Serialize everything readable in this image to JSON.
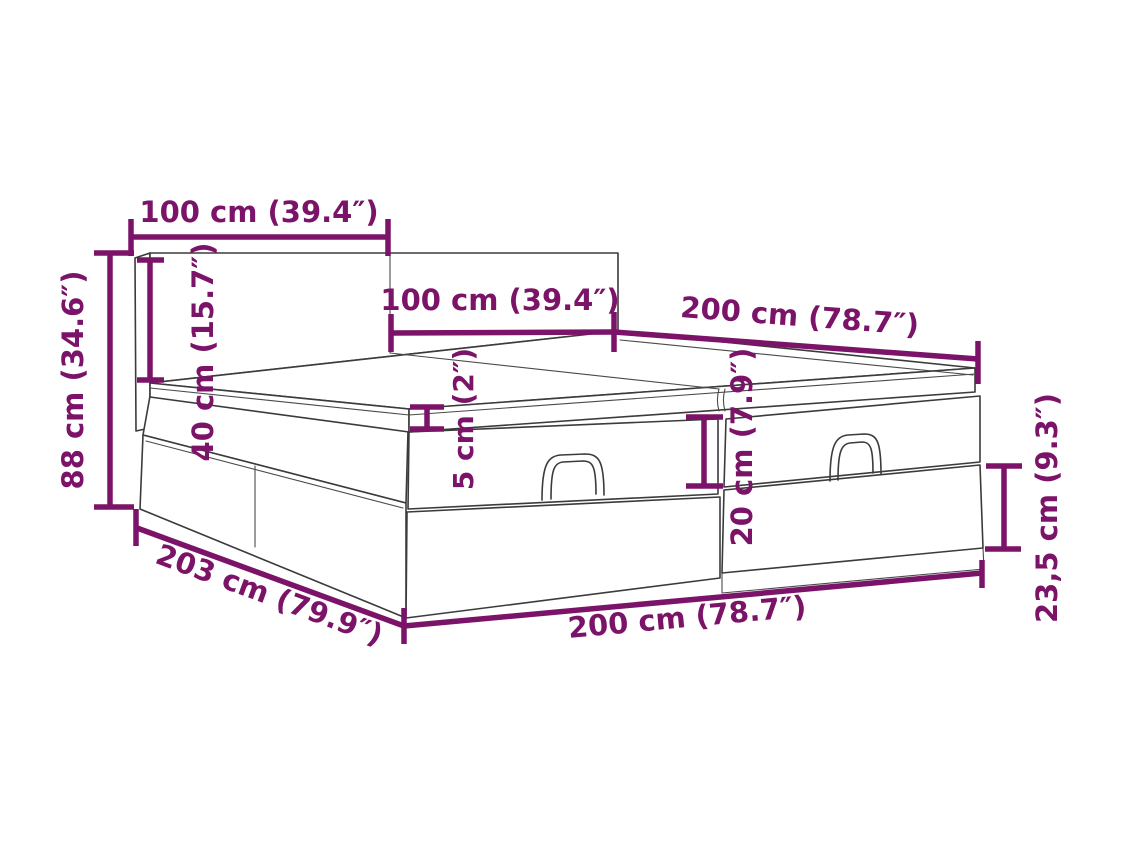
{
  "diagram": {
    "type": "furniture-dimension-diagram",
    "subject": "ottoman storage bed with headboard, two-piece base with handles",
    "colors": {
      "dimension_accent": "#7B1368",
      "line_art": "#3B3B3B",
      "background": "#FFFFFF"
    },
    "dimensions": [
      {
        "id": "headboard-left-panel-width",
        "label": "100 cm (39.4″)",
        "cm": 100,
        "inches": 39.4,
        "orientation": "horizontal"
      },
      {
        "id": "headboard-right-panel-width",
        "label": "100 cm (39.4″)",
        "cm": 100,
        "inches": 39.4,
        "orientation": "horizontal"
      },
      {
        "id": "mattress-side-length",
        "label": "200 cm (78.7″)",
        "cm": 200,
        "inches": 78.7,
        "orientation": "diagonal-right"
      },
      {
        "id": "total-height",
        "label": "88 cm (34.6″)",
        "cm": 88,
        "inches": 34.6,
        "orientation": "vertical"
      },
      {
        "id": "headboard-above-mattress",
        "label": "40 cm (15.7″)",
        "cm": 40,
        "inches": 15.7,
        "orientation": "vertical"
      },
      {
        "id": "mattress-topper-thickness",
        "label": "5 cm (2″)",
        "cm": 5,
        "inches": 2,
        "orientation": "vertical"
      },
      {
        "id": "upper-box-height",
        "label": "20 cm (7.9″)",
        "cm": 20,
        "inches": 7.9,
        "orientation": "vertical"
      },
      {
        "id": "lower-box-height",
        "label": "23,5 cm (9.3″)",
        "cm": 23.5,
        "inches": 9.3,
        "orientation": "vertical"
      },
      {
        "id": "frame-side-depth",
        "label": "203 cm (79.9″)",
        "cm": 203,
        "inches": 79.9,
        "orientation": "diagonal-left"
      },
      {
        "id": "frame-front-width",
        "label": "200 cm (78.7″)",
        "cm": 200,
        "inches": 78.7,
        "orientation": "diagonal-bottom"
      }
    ]
  }
}
